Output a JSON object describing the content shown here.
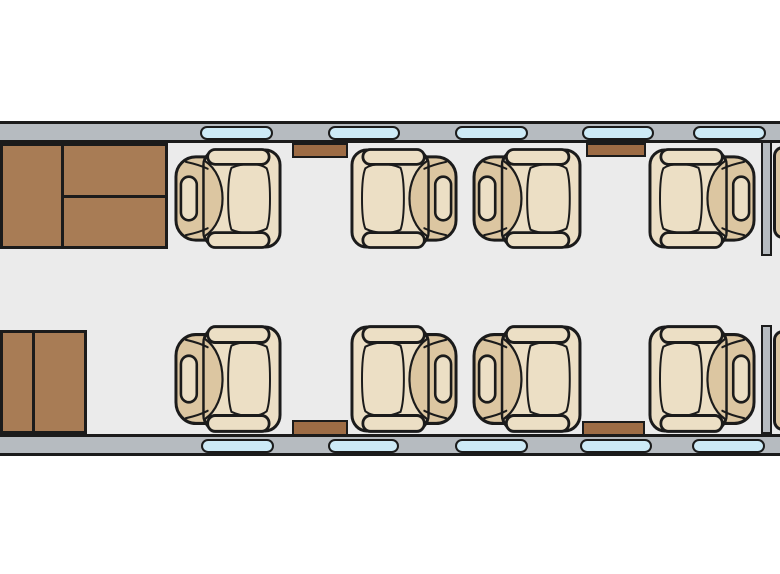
{
  "diagram": {
    "type": "aircraft-cabin-floor-plan",
    "canvas": {
      "width": 780,
      "height": 574
    },
    "colors": {
      "background": "#ffffff",
      "floor": "#ebebeb",
      "wall": "#b6bbc0",
      "window_glass": "#cdeaf6",
      "outline": "#1b1b1b",
      "cabinet_wood": "#a87c55",
      "table_wood": "#9d6c45",
      "seat_upholstery_light": "#ecdfc5",
      "seat_upholstery_tan": "#dcc6a1",
      "bulkhead": "#b6bbc0"
    },
    "fuselage": {
      "wall_top": {
        "x": 0,
        "y": 121,
        "w": 780,
        "h": 22
      },
      "wall_bottom": {
        "x": 0,
        "y": 434,
        "w": 780,
        "h": 22
      },
      "floor": {
        "x": 0,
        "y": 143,
        "w": 780,
        "h": 291
      }
    },
    "windows": {
      "top": {
        "y": 126,
        "h": 14,
        "items": [
          {
            "x": 200,
            "w": 73
          },
          {
            "x": 328,
            "w": 72
          },
          {
            "x": 455,
            "w": 73
          },
          {
            "x": 582,
            "w": 72
          },
          {
            "x": 693,
            "w": 73
          }
        ]
      },
      "bottom": {
        "y": 439,
        "h": 14,
        "items": [
          {
            "x": 201,
            "w": 73
          },
          {
            "x": 328,
            "w": 71
          },
          {
            "x": 455,
            "w": 73
          },
          {
            "x": 580,
            "w": 72
          },
          {
            "x": 692,
            "w": 73
          }
        ]
      }
    },
    "cabinets": [
      {
        "id": "galley-cabinet-forward",
        "x": 0,
        "y": 143,
        "w": 168,
        "h": 106,
        "dividers": [
          {
            "dir": "v",
            "at": 62,
            "from": 0,
            "to": 106
          },
          {
            "dir": "h",
            "at": 53,
            "from": 62,
            "to": 168
          }
        ]
      },
      {
        "id": "entry-cabinet-aft",
        "x": 0,
        "y": 330,
        "w": 87,
        "h": 104,
        "dividers": [
          {
            "dir": "v",
            "at": 33,
            "from": 0,
            "to": 104
          }
        ]
      }
    ],
    "side_tables": [
      {
        "id": "side-table-top-forward",
        "x": 292,
        "y": 143,
        "w": 56,
        "h": 15
      },
      {
        "id": "side-table-top-aft",
        "x": 586,
        "y": 143,
        "w": 60,
        "h": 14
      },
      {
        "id": "side-table-bottom-forward",
        "x": 292,
        "y": 420,
        "w": 56,
        "h": 16
      },
      {
        "id": "side-table-bottom-aft",
        "x": 582,
        "y": 421,
        "w": 63,
        "h": 15
      }
    ],
    "seats": [
      {
        "id": "seat-1",
        "row": "top",
        "facing": "right",
        "x": 172,
        "y": 148,
        "w": 111,
        "h": 101
      },
      {
        "id": "seat-2",
        "row": "top",
        "facing": "left",
        "x": 349,
        "y": 148,
        "w": 111,
        "h": 101
      },
      {
        "id": "seat-3",
        "row": "top",
        "facing": "right",
        "x": 470,
        "y": 148,
        "w": 113,
        "h": 101
      },
      {
        "id": "seat-4",
        "row": "top",
        "facing": "left",
        "x": 647,
        "y": 148,
        "w": 111,
        "h": 101
      },
      {
        "id": "seat-5",
        "row": "bottom",
        "facing": "right",
        "x": 172,
        "y": 325,
        "w": 111,
        "h": 108
      },
      {
        "id": "seat-6",
        "row": "bottom",
        "facing": "left",
        "x": 349,
        "y": 325,
        "w": 111,
        "h": 108
      },
      {
        "id": "seat-7",
        "row": "bottom",
        "facing": "right",
        "x": 470,
        "y": 325,
        "w": 113,
        "h": 108
      },
      {
        "id": "seat-8",
        "row": "bottom",
        "facing": "left",
        "x": 647,
        "y": 325,
        "w": 111,
        "h": 108
      }
    ],
    "aft_partition": {
      "segments": [
        {
          "id": "aft-bulkhead-upper",
          "x": 761,
          "y": 141,
          "w": 11,
          "h": 115
        },
        {
          "id": "aft-bulkhead-lower",
          "x": 761,
          "y": 325,
          "w": 11,
          "h": 109
        }
      ],
      "adjacent_seat_fragments": [
        {
          "id": "aft-cabin-seat-fragment-upper",
          "x": 773,
          "y": 146,
          "w": 16,
          "h": 93
        },
        {
          "id": "aft-cabin-seat-fragment-lower",
          "x": 773,
          "y": 330,
          "w": 16,
          "h": 101
        }
      ]
    }
  }
}
